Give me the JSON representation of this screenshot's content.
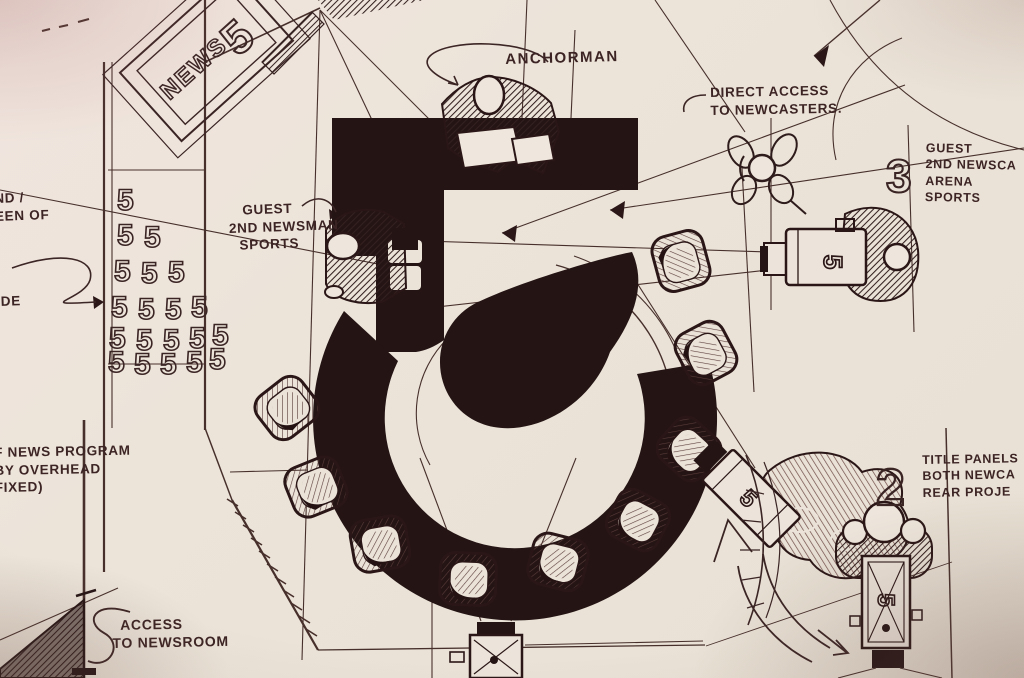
{
  "scene": {
    "description": "Hand-drawn plan sketch of a Channel 5 TV news studio set",
    "paper_color": "#ebe3d8",
    "ink_color": "#2b1717"
  },
  "labels": {
    "anchorman": "ANCHORMAN",
    "direct_access": {
      "line1": "DIRECT ACCESS",
      "line2": "TO NEWCASTERS."
    },
    "guest_newscaster_right": {
      "number": "3",
      "line1": "GUEST",
      "line2": "2ND NEWSCA",
      "line3": "ARENA",
      "line4": "SPORTS"
    },
    "guest_newsman_left": {
      "line1": "GUEST",
      "line2": "2ND NEWSMAN",
      "line3": "SPORTS"
    },
    "left_edge_upper": {
      "line1": "ND /",
      "line2": "EEN OF"
    },
    "left_edge_middle": "IDE",
    "news_program": {
      "line1": "F NEWS PROGRAM",
      "line2": "BY OVERHEAD",
      "line3": "FIXED)"
    },
    "title_panels": {
      "number": "2",
      "line1": "TITLE PANELS",
      "line2": "BOTH NEWCA",
      "line3": "REAR PROJE"
    },
    "access_newsroom": {
      "line1": "ACCESS",
      "line2": "TO NEWSROOM"
    },
    "studio_panel": {
      "word": "NEWS",
      "number": "5"
    },
    "camera_badge": "5",
    "logo_wall_glyph": "5"
  }
}
